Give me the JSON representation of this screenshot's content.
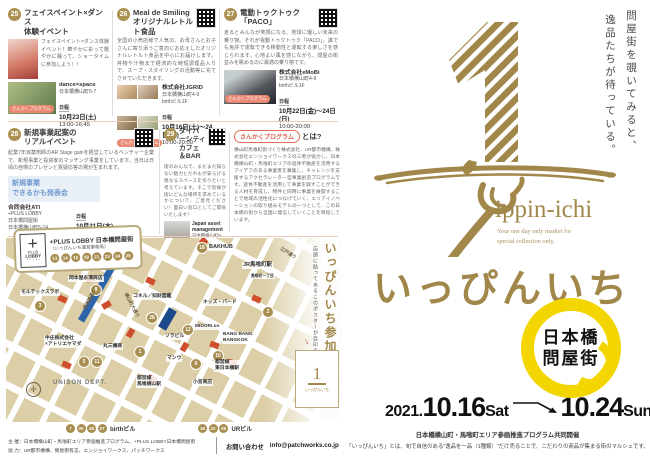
{
  "labels": {
    "schedule": "日程"
  },
  "cards": [
    {
      "number": "25",
      "title": "フェイスペイント×ダンス\n体験イベント",
      "body": "フェイスペイント×ダンス体験イベント！華やかに彩って軽やかに踊って、ショータイムに参加しよう！！",
      "venue": "dance×space",
      "address": "日本橋横山町5-7",
      "date": "10月23日(土)",
      "time": "13:00-16:45",
      "badge": "さんかくプログラム"
    },
    {
      "number": "26",
      "title": "Meal de Smiling\nオリジナルレトルト食品",
      "body": "全国の小売店様で人気の、お母さんとお子さんに寄り添うご意向にお応えしたオリジナルレトルト食品を中心にお届けします。丼物や汁物まで経済的な時短調理品入りで、スープ・スタイリングの活動等に充てさせていただきます。",
      "venue": "株式会社JGRID",
      "address": "日本橋横山町4-9\nbirthビル1F",
      "date": "10月16日(土)〜24日(日)",
      "time": "10:00-20:00",
      "badge": "さんかくプログラム"
    },
    {
      "number": "27",
      "title": "電動トゥクトゥク\n「PACO」",
      "body": "走るとみんなが笑顔になる、地球に優しい未来の乗り物。それが電動トゥクトゥク「PACO」。誰でも免許で運転できる移動性と運転する楽しさを感じられます。心地よい風を感じながら、問屋の街並みを眺めるのに最適の乗り物です。",
      "venue": "株式会社eMoBi",
      "address": "日本橋横山町4-9\nbirthビル1F",
      "date": "10月22日(金)〜24日(日)",
      "time": "10:00-20:00",
      "badge": "さんかくプログラム"
    },
    {
      "number": "28",
      "title": "新規事業起案の\nリアルイベント",
      "body": "起業7年目薬剤師のAR Stage gainを経営しているベンチャー企業で、新規事業と投資家のマッチング事業をしています。当日は日頃の自慢のプレゼンと質疑応答の場が生まれます。",
      "banner": "新規事業\nできるかも発表会",
      "venue": "合同会社ATI",
      "address": "+PLUS LOBBY\n日本橋問屋街\n日本橋横山町6-14",
      "date": "10月21日(木)",
      "time": "19:00-21:00",
      "badge": "さんかくプログラム"
    },
    {
      "number": "29",
      "title": "ダイバーシティカフェ\n＆BAR",
      "body": "街のみんなで、まだまだ知らない魅力とだれもが安らげる異なるスペースを作りたいと考えています。そこで皆様が街にどんな場所を求めているかについて、ご意見ください！面白い窓口としてご関係いたします！",
      "venue": "Japan asset\nmanagement",
      "address": "日本橋横山町5-18\nURビル1F",
      "date": "10月22日(金)",
      "time": "14:00-21:00",
      "badge": "さんかくプログラム"
    }
  ],
  "sankaku": {
    "badge": "さんかくプログラム",
    "title_suffix": "とは?",
    "body": "横山町馬喰町街づくり株式会社、UR都市機構、株式会社エンジョイワークスの三者が協力し、日本橋横山町・馬喰町エリアの遊休不動産を活用するアイデアのある事業者を募集し、チャレンジを支援するアクセラレーター型事業創造プログラムです。遊休不動産を活用して事業を興すことができる人材を育成し、物件と同時に事業を展開することで地域の活性化につなげていく、エリアイノベーションの取り組みモデルの一つとして、この日本橋の街から全国に発信していくことを目指しています。"
  },
  "map": {
    "office_box": {
      "logo_plus": "＋",
      "logo_line1": "PLUS",
      "logo_line2": "LOBBY",
      "logo_dots": "・・・・・",
      "title": "+PLUS LOBBY 日本橋問屋街",
      "subtitle": "（いっぴんいち運営事務局）",
      "numbers": [
        "13",
        "14",
        "15",
        "19",
        "21",
        "23",
        "24",
        "25"
      ]
    },
    "side_title": "いっぴんいち参加店マップ",
    "side_note": "店頭に貼ってあるこのポスターが目印です!",
    "side_arrow": "↓",
    "thumb_glyph": "1",
    "thumb_text": "いっぴんいち",
    "labels": [
      "JR馬喰町駅",
      "馬喰町一丁目",
      "岡本屋永澤商店",
      "モルテックスラボ",
      "清洲橋通り",
      "江戸通り",
      "横山町大通り",
      "コネル／知財図鑑",
      "キッズ・バード",
      "ソラビル",
      "MIDORI.so",
      "BANG BANG\nBANGKOK",
      "マンウ",
      "丸三機商",
      "中庄株式会社\n×アトリエヤマダ",
      "UNISON DEPT.",
      "都営線\n馬喰横山駅",
      "都営線\n東日本橋駅",
      "小宮商店",
      "BAKHUB"
    ],
    "circles": [
      "8",
      "3",
      "12",
      "28",
      "2",
      "10",
      "1",
      "6",
      "5",
      "11",
      "18"
    ],
    "legend": [
      {
        "numbers": [
          "7",
          "20",
          "26",
          "27"
        ],
        "name": "birthビル"
      },
      {
        "numbers": [
          "16",
          "22",
          "29"
        ],
        "name": "URビル"
      }
    ]
  },
  "footer": {
    "organizer": "主 催：日本橋横山町・馬喰町エリア参画推進プログラム、+PLUS LOBBY日本橋問屋街",
    "cooperation": "協 力：UR都市機構、問屋街有志、エンジョイワークス、パッチワークス",
    "contact_label": "お問い合わせ",
    "contact_email": "info@patchworks.co.jp"
  },
  "poster": {
    "tagline_line1": "問屋街を覗いてみると、",
    "tagline_line2": "逸品たちが待っている。",
    "logo_en": "ippin-ichi",
    "logo_sub": "Your one day only market for\nspecial collection only.",
    "logo_jp": "いっぴんいち",
    "location_line1": "日本橋",
    "location_line2": "問屋街",
    "date_year": "2021.",
    "date_start": "10.16",
    "date_start_day": "Sat",
    "date_end": "10.24",
    "date_end_day": "Sun",
    "co_host": "日本橋横山町・馬喰町エリア参画推進プログラム共同開催",
    "description": "「いっぴんいち」とは、旬で自信のある\"逸品を一品（1種類）\"だけ売ることで、こだわりの商品が集まる街のマルシェです。"
  }
}
